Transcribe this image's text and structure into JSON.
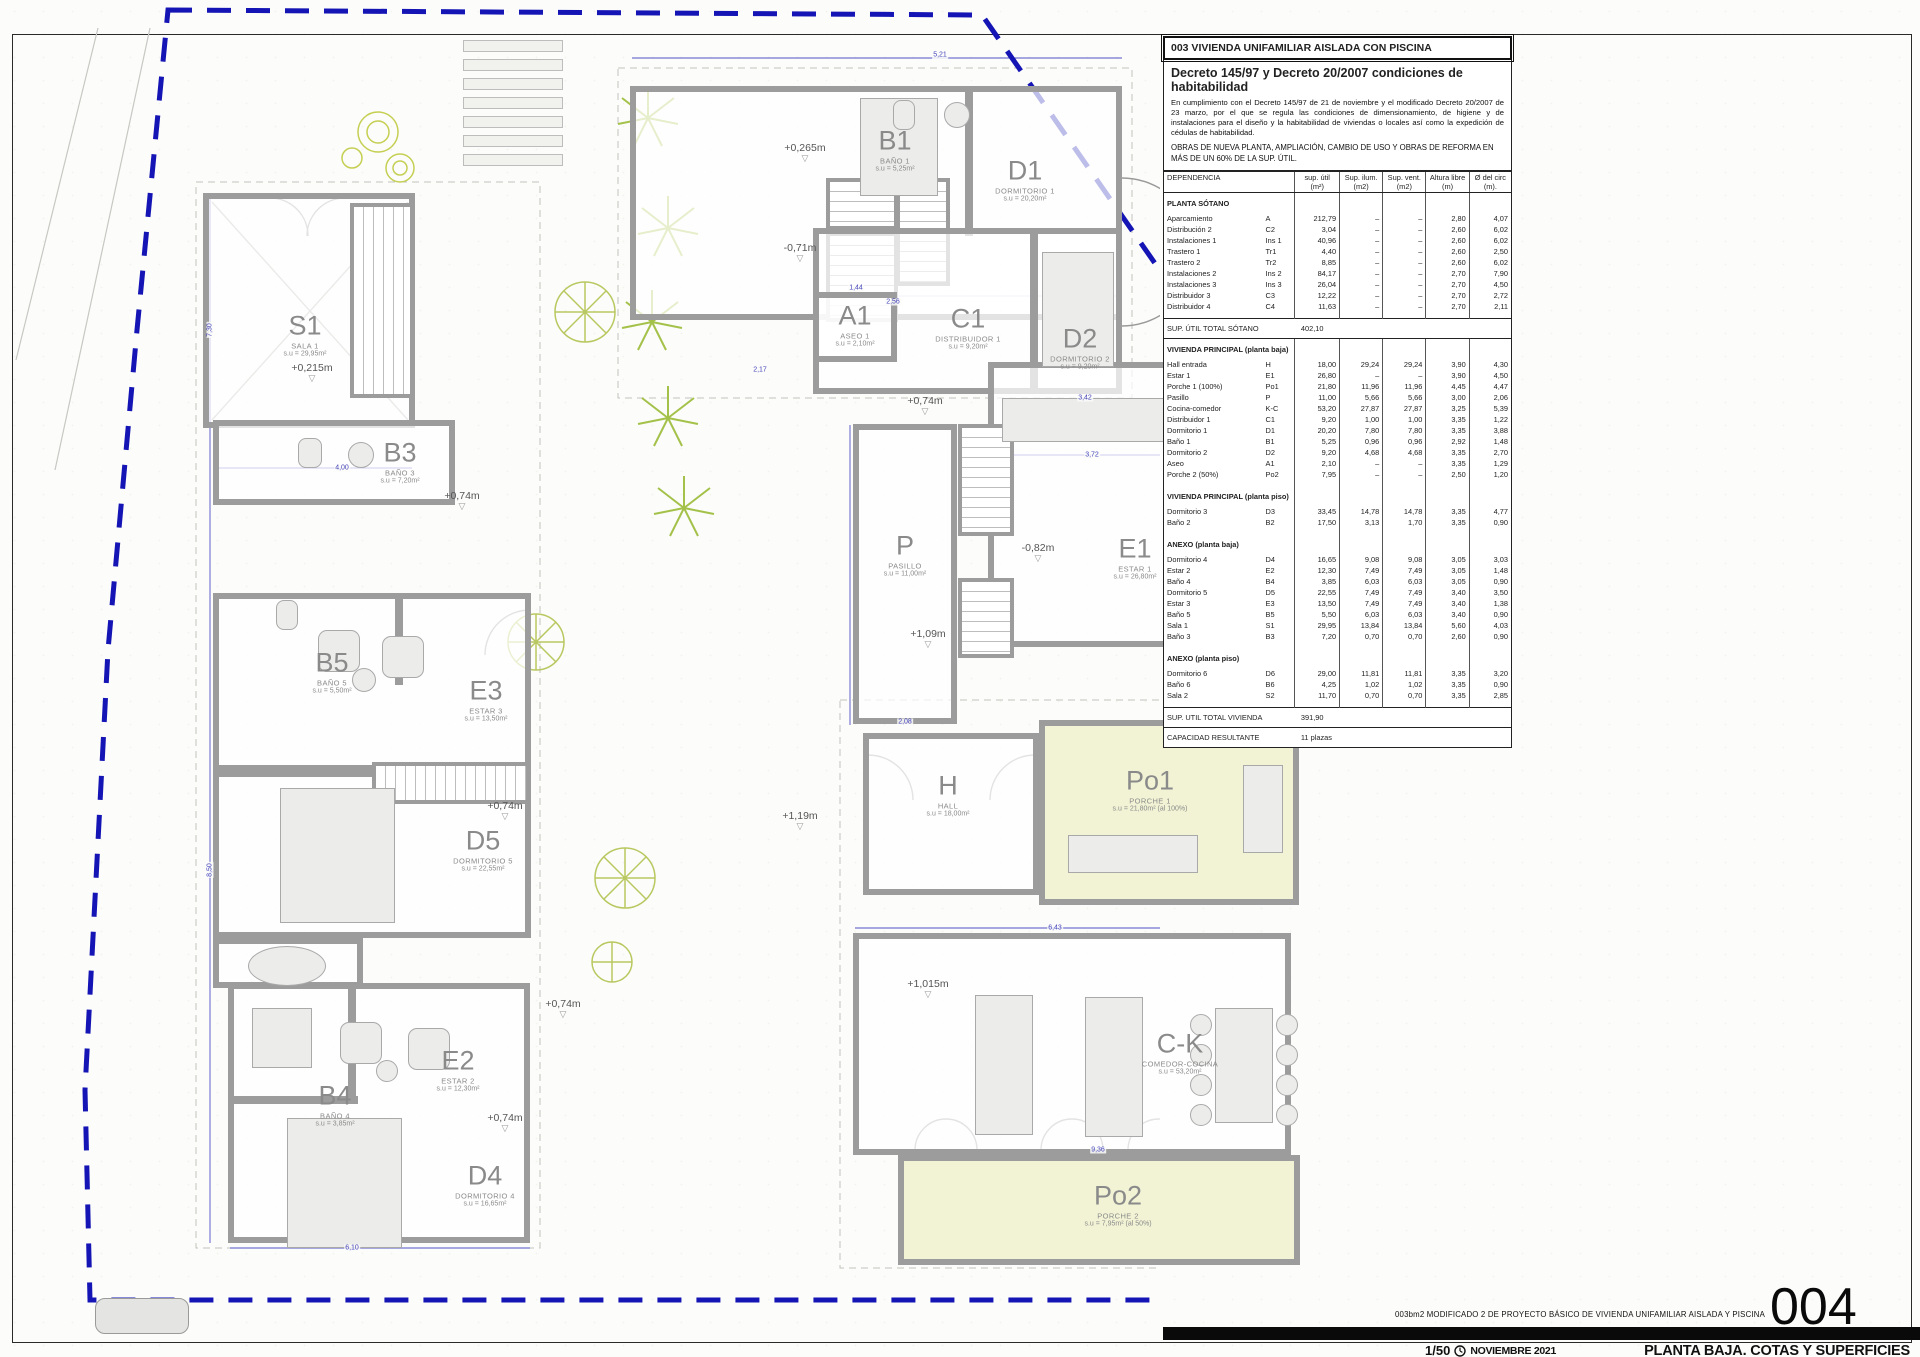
{
  "sheet": {
    "number": "004",
    "title": "PLANTA BAJA. COTAS Y SUPERFICIES",
    "scale": "1/50",
    "date": "NOVIEMBRE 2021",
    "project_line": "003bm2   MODIFICADO 2 DE PROYECTO BÁSICO DE VIVIENDA UNIFAMILIAR AISLADA Y PISCINA"
  },
  "panel": {
    "header": "003 VIVIENDA UNIFAMILIAR AISLADA CON PISCINA",
    "decree": {
      "title": "Decreto 145/97 y Decreto 20/2007 condiciones de habitabilidad",
      "body": "En cumplimiento con el Decreto 145/97 de 21 de noviembre y el modificado Decreto 20/2007 de 23 marzo, por el que se regula las condiciones de dimensionamiento, de higiene y de instalaciones para el diseño y la habitabilidad de viviendas o locales así como la expedición de cédulas de habitabilidad.",
      "obras": "OBRAS DE NUEVA PLANTA, AMPLIACIÓN, CAMBIO DE USO Y OBRAS DE REFORMA EN MÁS DE UN 60% DE LA SUP. ÚTIL."
    },
    "table": {
      "headers": [
        "DEPENDENCIA",
        "sup. útil (m²)",
        "Sup. ilum. (m2)",
        "Sup. vent. (m2)",
        "Altura libre (m)",
        "Ø del circ (m)."
      ],
      "blocks": [
        {
          "type": "group",
          "title": "PLANTA SÓTANO",
          "rows": [
            [
              "Aparcamiento",
              "A",
              "212,79",
              "–",
              "–",
              "2,80",
              "4,07"
            ],
            [
              "Distribución 2",
              "C2",
              "3,04",
              "–",
              "–",
              "2,60",
              "6,02"
            ],
            [
              "Instalaciones 1",
              "Ins 1",
              "40,96",
              "–",
              "–",
              "2,60",
              "6,02"
            ],
            [
              "Trastero 1",
              "Tr1",
              "4,40",
              "–",
              "–",
              "2,60",
              "2,50"
            ],
            [
              "Trastero 2",
              "Tr2",
              "8,85",
              "–",
              "–",
              "2,60",
              "6,02"
            ],
            [
              "Instalaciones 2",
              "Ins 2",
              "84,17",
              "–",
              "–",
              "2,70",
              "7,90"
            ],
            [
              "Instalaciones 3",
              "Ins 3",
              "26,04",
              "–",
              "–",
              "2,70",
              "4,50"
            ],
            [
              "Distribuidor 3",
              "C3",
              "12,22",
              "–",
              "–",
              "2,70",
              "2,72"
            ],
            [
              "Distribuidor 4",
              "C4",
              "11,63",
              "–",
              "–",
              "2,70",
              "2,11"
            ]
          ]
        },
        {
          "type": "total",
          "label": "SUP. ÚTIL TOTAL SÓTANO",
          "value": "402,10"
        },
        {
          "type": "group",
          "title": "VIVIENDA PRINCIPAL (planta baja)",
          "rows": [
            [
              "Hall entrada",
              "H",
              "18,00",
              "29,24",
              "29,24",
              "3,90",
              "4,30"
            ],
            [
              "Estar 1",
              "E1",
              "26,80",
              "–",
              "–",
              "3,90",
              "4,50"
            ],
            [
              "Porche 1 (100%)",
              "Po1",
              "21,80",
              "11,96",
              "11,96",
              "4,45",
              "4,47"
            ],
            [
              "Pasillo",
              "P",
              "11,00",
              "5,66",
              "5,66",
              "3,00",
              "2,06"
            ],
            [
              "Cocina-comedor",
              "K-C",
              "53,20",
              "27,87",
              "27,87",
              "3,25",
              "5,39"
            ],
            [
              "Distribuidor 1",
              "C1",
              "9,20",
              "1,00",
              "1,00",
              "3,35",
              "1,22"
            ],
            [
              "Dormitorio 1",
              "D1",
              "20,20",
              "7,80",
              "7,80",
              "3,35",
              "3,88"
            ],
            [
              "Baño 1",
              "B1",
              "5,25",
              "0,96",
              "0,96",
              "2,92",
              "1,48"
            ],
            [
              "Dormitorio 2",
              "D2",
              "9,20",
              "4,68",
              "4,68",
              "3,35",
              "2,70"
            ],
            [
              "Aseo",
              "A1",
              "2,10",
              "–",
              "–",
              "3,35",
              "1,29"
            ],
            [
              "Porche 2 (50%)",
              "Po2",
              "7,95",
              "–",
              "–",
              "2,50",
              "1,20"
            ]
          ]
        },
        {
          "type": "group",
          "title": "VIVIENDA PRINCIPAL (planta piso)",
          "rows": [
            [
              "Dormitorio 3",
              "D3",
              "33,45",
              "14,78",
              "14,78",
              "3,35",
              "4,77"
            ],
            [
              "Baño 2",
              "B2",
              "17,50",
              "3,13",
              "1,70",
              "3,35",
              "0,90"
            ]
          ]
        },
        {
          "type": "group",
          "title": "ANEXO (planta baja)",
          "rows": [
            [
              "Dormitorio 4",
              "D4",
              "16,65",
              "9,08",
              "9,08",
              "3,05",
              "3,03"
            ],
            [
              "Estar 2",
              "E2",
              "12,30",
              "7,49",
              "7,49",
              "3,05",
              "1,48"
            ],
            [
              "Baño 4",
              "B4",
              "3,85",
              "6,03",
              "6,03",
              "3,05",
              "0,90"
            ],
            [
              "Dormitorio 5",
              "D5",
              "22,55",
              "7,49",
              "7,49",
              "3,40",
              "3,50"
            ],
            [
              "Estar 3",
              "E3",
              "13,50",
              "7,49",
              "7,49",
              "3,40",
              "1,38"
            ],
            [
              "Baño 5",
              "B5",
              "5,50",
              "6,03",
              "6,03",
              "3,40",
              "0,90"
            ],
            [
              "Sala 1",
              "S1",
              "29,95",
              "13,84",
              "13,84",
              "5,60",
              "4,03"
            ],
            [
              "Baño 3",
              "B3",
              "7,20",
              "0,70",
              "0,70",
              "2,60",
              "0,90"
            ]
          ]
        },
        {
          "type": "group",
          "title": "ANEXO (planta piso)",
          "rows": [
            [
              "Dormitorio 6",
              "D6",
              "29,00",
              "11,81",
              "11,81",
              "3,35",
              "3,20"
            ],
            [
              "Baño 6",
              "B6",
              "4,25",
              "1,02",
              "1,02",
              "3,35",
              "0,90"
            ],
            [
              "Sala 2",
              "S2",
              "11,70",
              "0,70",
              "0,70",
              "3,35",
              "2,85"
            ]
          ]
        },
        {
          "type": "total",
          "label": "SUP. UTIL TOTAL VIVIENDA",
          "value": "391,90"
        },
        {
          "type": "total",
          "label": "CAPACIDAD RESULTANTE",
          "value": "11 plazas"
        }
      ]
    }
  },
  "plan": {
    "rooms": [
      {
        "code": "S1",
        "name": "SALA 1",
        "area": "s.u = 29,95m²"
      },
      {
        "code": "B3",
        "name": "BAÑO 3",
        "area": "s.u = 7,20m²"
      },
      {
        "code": "B5",
        "name": "BAÑO 5",
        "area": "s.u = 5,50m²"
      },
      {
        "code": "E3",
        "name": "ESTAR 3",
        "area": "s.u = 13,50m²"
      },
      {
        "code": "D5",
        "name": "DORMITORIO 5",
        "area": "s.u = 22,55m²"
      },
      {
        "code": "E2",
        "name": "ESTAR 2",
        "area": "s.u = 12,30m²"
      },
      {
        "code": "B4",
        "name": "BAÑO 4",
        "area": "s.u = 3,85m²"
      },
      {
        "code": "D4",
        "name": "DORMITORIO 4",
        "area": "s.u = 16,65m²"
      },
      {
        "code": "B1",
        "name": "BAÑO 1",
        "area": "s.u = 5,25m²"
      },
      {
        "code": "D1",
        "name": "DORMITORIO 1",
        "area": "s.u = 20,20m²"
      },
      {
        "code": "A1",
        "name": "ASEO 1",
        "area": "s.u = 2,10m²"
      },
      {
        "code": "C1",
        "name": "DISTRIBUIDOR 1",
        "area": "s.u = 9,20m²"
      },
      {
        "code": "D2",
        "name": "DORMITORIO 2",
        "area": "s.u = 9,20m²"
      },
      {
        "code": "P",
        "name": "PASILLO",
        "area": "s.u = 11,00m²"
      },
      {
        "code": "E1",
        "name": "ESTAR 1",
        "area": "s.u = 26,80m²"
      },
      {
        "code": "H",
        "name": "HALL",
        "area": "s.u = 18,00m²"
      },
      {
        "code": "Po1",
        "name": "PORCHE 1",
        "area": "s.u = 21,80m² (al 100%)"
      },
      {
        "code": "C-K",
        "name": "COMEDOR-COCINA",
        "area": "s.u = 53,20m²"
      },
      {
        "code": "Po2",
        "name": "PORCHE 2",
        "area": "s.u = 7,95m² (al 50%)"
      }
    ],
    "levels": [
      "+0,265m",
      "-0,71m",
      "+0,74m",
      "+0,215m",
      "+0,74m",
      "+0,74m",
      "+0,74m",
      "+1,09m",
      "-0,82m",
      "+1,19m",
      "+1,015m",
      "+0,74m"
    ],
    "dims": [
      "5,21",
      "2,56",
      "1,44",
      "3,42",
      "3,72",
      "1,05",
      "2,17",
      "7,30",
      "8,50",
      "4,00",
      "6,43",
      "9,36",
      "6,10",
      "2,08"
    ],
    "bed_label": "1,80x2m"
  }
}
